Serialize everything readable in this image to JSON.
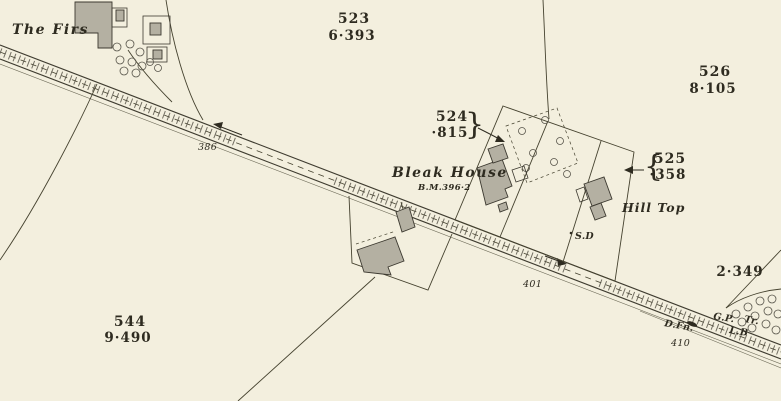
{
  "colors": {
    "paper": "#f3efde",
    "ink": "#3c3930",
    "building_fill": "#b4b0a2",
    "label": "#2e2b20"
  },
  "parcels": {
    "p523": {
      "number": "523",
      "acreage": "6·393"
    },
    "p524": {
      "number": "524",
      "acreage": "·815"
    },
    "p525": {
      "number": "525",
      "acreage": "·358"
    },
    "p526": {
      "number": "526",
      "acreage": "8·105"
    },
    "p544": {
      "number": "544",
      "acreage": "9·490"
    },
    "east": {
      "acreage": "2·349"
    }
  },
  "places": {
    "the_firs": "The Firs",
    "bleak_house": "Bleak House",
    "bleak_house_benchmark": "B.M.396·2",
    "hill_top": "Hill Top",
    "sundial": "S.D"
  },
  "road_marks": {
    "level_386": "386",
    "level_401": "401",
    "level_410": "410",
    "drinking_fountain": "D.Fn.",
    "guide_post": "G.P.",
    "trough": "Tr.",
    "letter_box": "L.B"
  },
  "annotations": {
    "brace_right": "}",
    "brace_left": "{"
  }
}
